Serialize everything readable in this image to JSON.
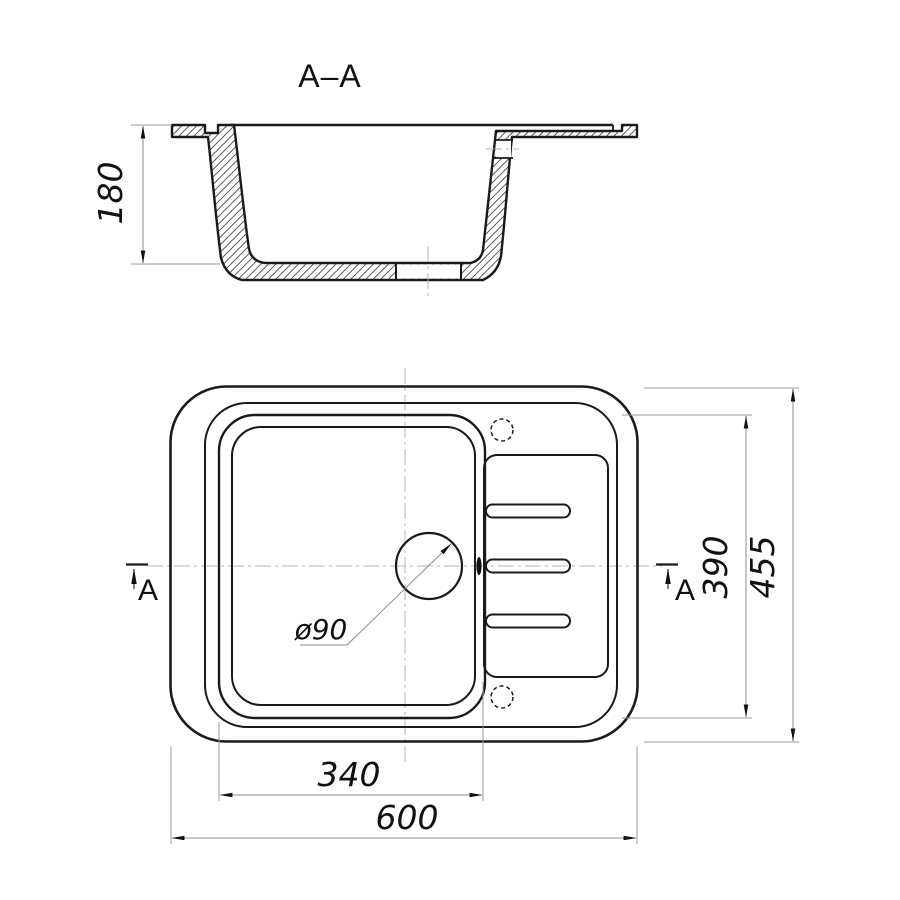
{
  "section": {
    "title": "A–A",
    "depth": "180"
  },
  "plan": {
    "overall_width": "600",
    "overall_depth": "455",
    "bowl_width": "340",
    "bowl_depth": "390",
    "drain": "ø90",
    "marker": "A"
  },
  "colors": {
    "line": "#1a1a1a",
    "aux": "#9b9b9b",
    "centerline": "#b5b5b5",
    "text": "#111111",
    "background": "#ffffff"
  }
}
